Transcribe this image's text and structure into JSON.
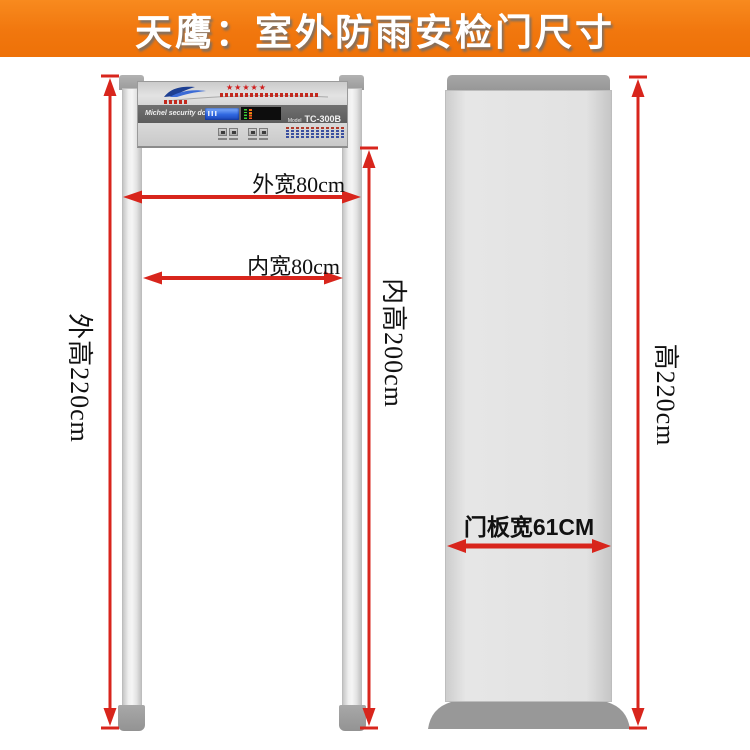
{
  "header": {
    "title": "天鹰：室外防雨安检门尺寸",
    "bg_color": "#f1770e",
    "text_color": "#ffffff"
  },
  "colors": {
    "dimension_red": "#d8251c",
    "panel_dark_strip": "#636363",
    "lcd_blue": "#2f67e0",
    "structure_gray": "#e2e2e2",
    "cap_gray": "#9b9b9b"
  },
  "front_view": {
    "panel": {
      "brand_text": "Michel security door",
      "stars": "★★★★★",
      "model_label": "Model",
      "model_value": "TC-300B"
    },
    "dimensions": {
      "outer_width_label": "外宽80cm",
      "inner_width_label": "内宽80cm",
      "outer_height_label": "外高220cm",
      "inner_height_label": "内高200cm"
    }
  },
  "side_view": {
    "dimensions": {
      "panel_width_label": "门板宽61CM",
      "height_label": "高220cm"
    }
  }
}
